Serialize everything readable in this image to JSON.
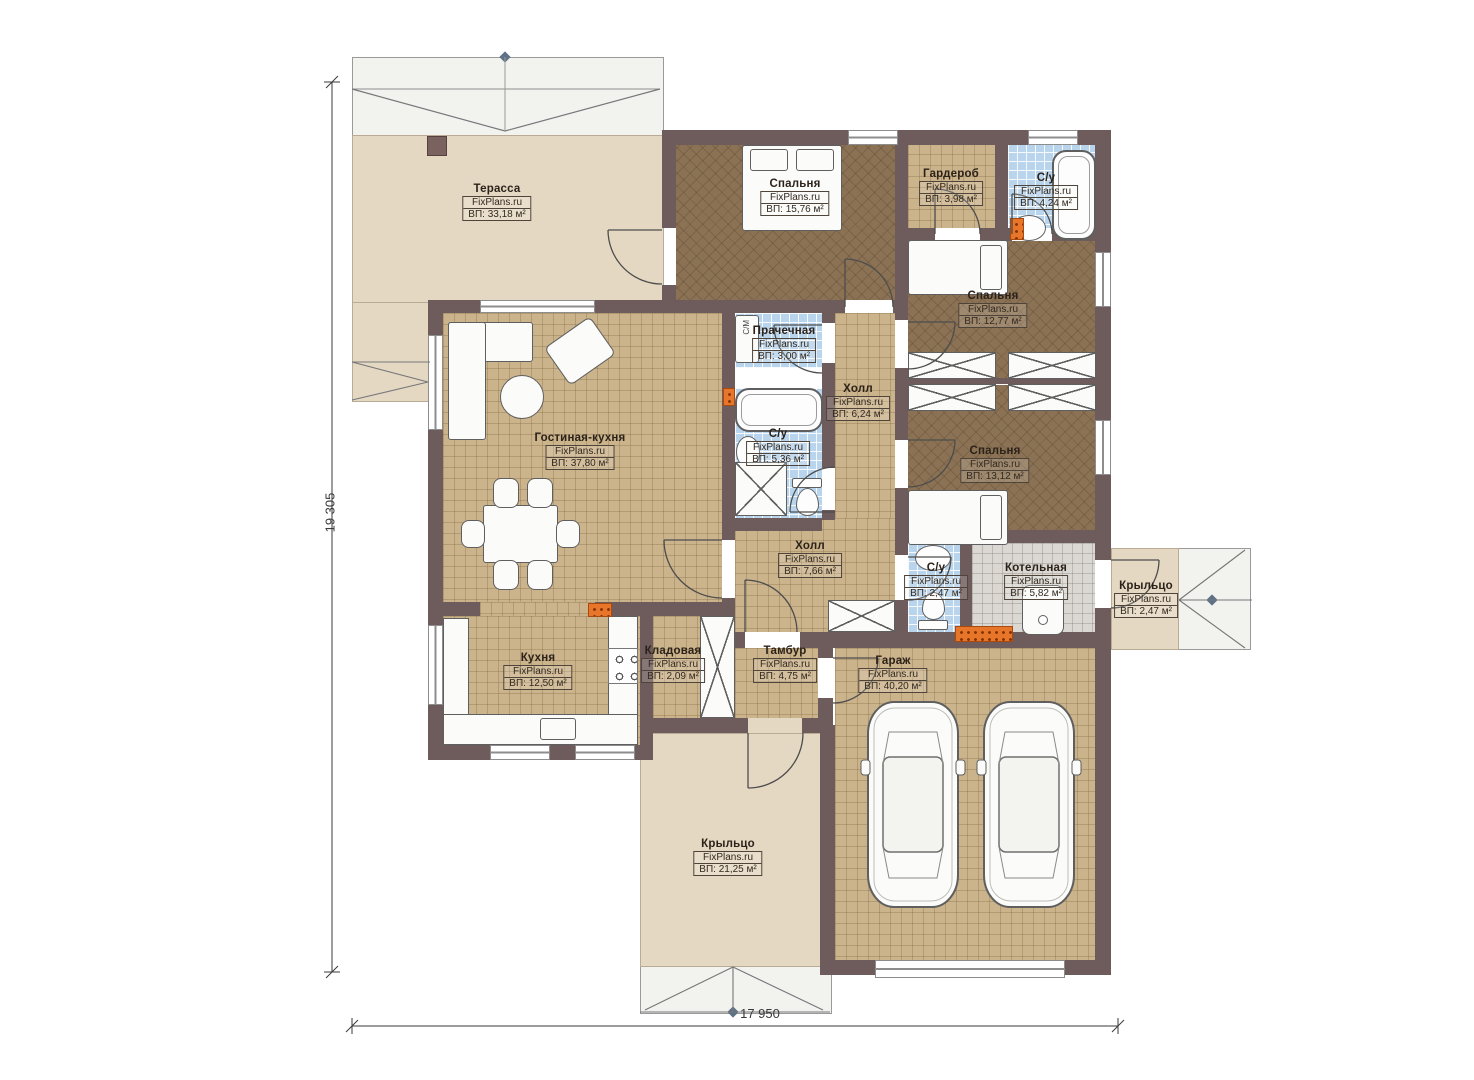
{
  "watermark": "FixPlans.ru",
  "dimensions": {
    "left": "19 305",
    "bottom": "17 950"
  },
  "annotations": {
    "washing_machine": "С/М"
  },
  "colors": {
    "wall": "#6e5b5b",
    "floor_tile_tan": "#cbb38b",
    "floor_wood_brown": "#8b7254",
    "floor_bath_blue": "#b9d5ee",
    "floor_boiler_gray": "#dbd8d3",
    "floor_terrace_beige": "#e5d8c3",
    "roof_overhang": "#f2f2ef",
    "radiator_orange": "#e8762a"
  },
  "rooms": {
    "terrace": {
      "name": "Терасса",
      "wm": "FixPlans.ru",
      "area": "ВП: 33,18 м²"
    },
    "bedroom1": {
      "name": "Спальня",
      "wm": "FixPlans.ru",
      "area": "ВП: 15,76 м²"
    },
    "wardrobe": {
      "name": "Гардероб",
      "wm": "FixPlans.ru",
      "area": "ВП: 3,98 м²"
    },
    "bath1": {
      "name": "С/у",
      "wm": "FixPlans.ru",
      "area": "ВП: 4,24 м²"
    },
    "bedroom2": {
      "name": "Спальня",
      "wm": "FixPlans.ru",
      "area": "ВП: 12,77 м²"
    },
    "laundry": {
      "name": "Прачечная",
      "wm": "FixPlans.ru",
      "area": "ВП: 3,00 м²"
    },
    "hall1": {
      "name": "Холл",
      "wm": "FixPlans.ru",
      "area": "ВП: 6,24 м²"
    },
    "bath2": {
      "name": "С/у",
      "wm": "FixPlans.ru",
      "area": "ВП: 5,36 м²"
    },
    "living": {
      "name": "Гостиная-кухня",
      "wm": "FixPlans.ru",
      "area": "ВП: 37,80 м²"
    },
    "bedroom3": {
      "name": "Спальня",
      "wm": "FixPlans.ru",
      "area": "ВП: 13,12 м²"
    },
    "hall2": {
      "name": "Холл",
      "wm": "FixPlans.ru",
      "area": "ВП: 7,66 м²"
    },
    "bath3": {
      "name": "С/у",
      "wm": "FixPlans.ru",
      "area": "ВП: 2,47 м²"
    },
    "boiler": {
      "name": "Котельная",
      "wm": "FixPlans.ru",
      "area": "ВП: 5,82 м²"
    },
    "porch_right": {
      "name": "Крыльцо",
      "wm": "FixPlans.ru",
      "area": "ВП: 2,47 м²"
    },
    "kitchen": {
      "name": "Кухня",
      "wm": "FixPlans.ru",
      "area": "ВП: 12,50 м²"
    },
    "pantry": {
      "name": "Кладовая",
      "wm": "FixPlans.ru",
      "area": "ВП: 2,09 м²"
    },
    "vestibule": {
      "name": "Тамбур",
      "wm": "FixPlans.ru",
      "area": "ВП: 4,75 м²"
    },
    "garage": {
      "name": "Гараж",
      "wm": "FixPlans.ru",
      "area": "ВП: 40,20 м²"
    },
    "porch_bottom": {
      "name": "Крыльцо",
      "wm": "FixPlans.ru",
      "area": "ВП: 21,25 м²"
    }
  }
}
